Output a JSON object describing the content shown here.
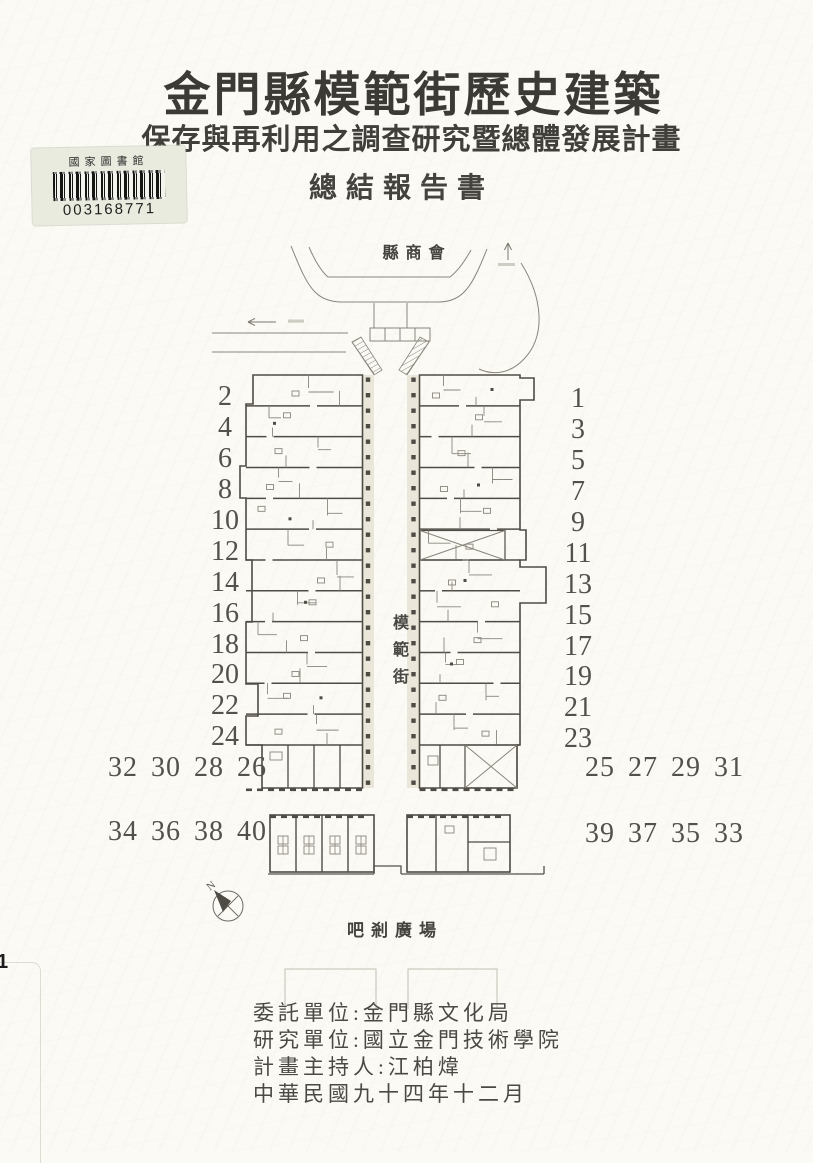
{
  "cover": {
    "title": "金門縣模範街歷史建築",
    "subtitle": "保存與再利用之調查研究暨總體發展計畫",
    "report_type": "總結報告書"
  },
  "library_sticker": {
    "library_name": "國家圖書館",
    "barcode_number": "003168771"
  },
  "plan": {
    "top_label": "縣商會",
    "street_label": "模範街",
    "plaza_label": "吧剎廣場",
    "compass_label": "N",
    "left_numbers": [
      "2",
      "4",
      "6",
      "8",
      "10",
      "12",
      "14",
      "16",
      "18",
      "20",
      "22",
      "24"
    ],
    "right_numbers": [
      "1",
      "3",
      "5",
      "7",
      "9",
      "11",
      "13",
      "15",
      "17",
      "19",
      "21",
      "23"
    ],
    "bottom_row1_left": "32 30 28 26",
    "bottom_row1_right": "25 27 29 31",
    "bottom_row2_left": "34 36 38 40",
    "bottom_row2_right": "39 37 35 33"
  },
  "credits": {
    "lines": [
      "委託單位:金門縣文化局",
      "研究單位:國立金門技術學院",
      "計畫主持人:江柏煒",
      "中華民國九十四年十二月"
    ]
  },
  "edge_mark": "1",
  "colors": {
    "paper": "#fbfaf5",
    "ink": "#3c3a35",
    "plan_line_light": "#8a867c",
    "plan_line_dark": "#4f4c45",
    "sticker_bg": "#e9ebdf"
  }
}
